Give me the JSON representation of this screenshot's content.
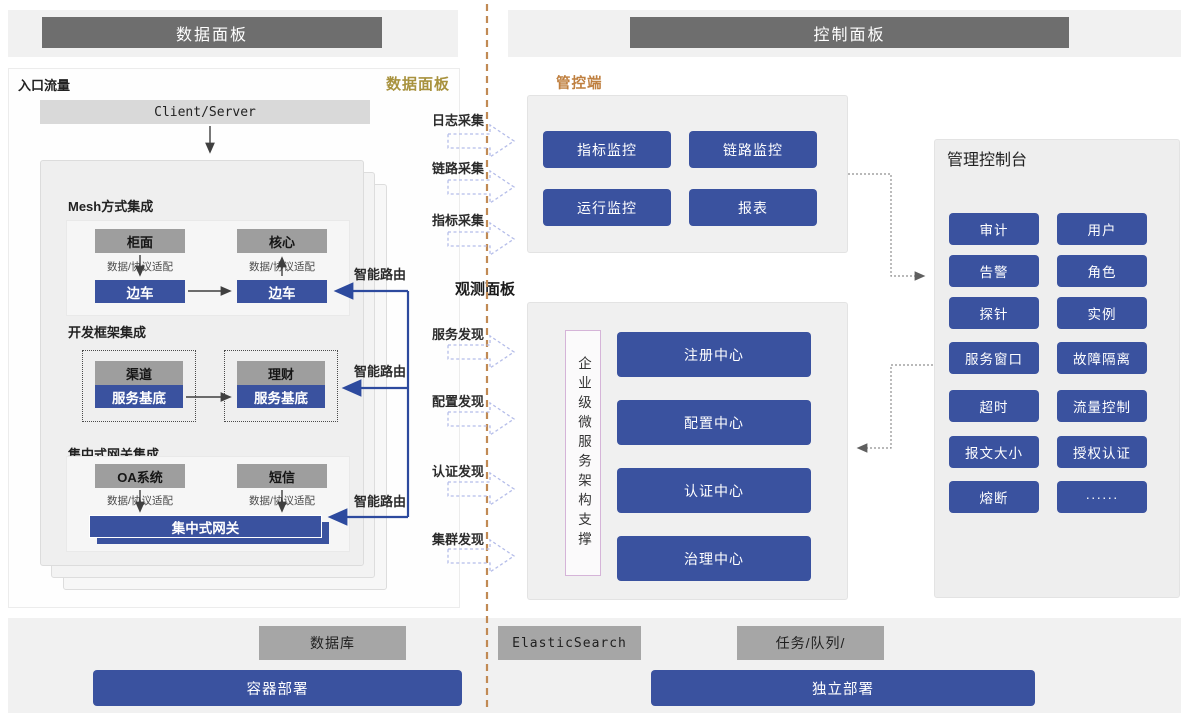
{
  "page": {
    "left_header": "数据面板",
    "right_header": "控制面板"
  },
  "data_plane": {
    "entry_label": "入口流量",
    "panel_tag": "数据面板",
    "client_server": "Client/Server",
    "mesh": {
      "title": "Mesh方式集成",
      "box1": "柜面",
      "adapter1": "数据/协议适配",
      "sidecar1": "边车",
      "box2": "核心",
      "adapter2": "数据/协议适配",
      "sidecar2": "边车"
    },
    "framework": {
      "title": "开发框架集成",
      "box1": "渠道",
      "base1": "服务基底",
      "box2": "理财",
      "base2": "服务基底"
    },
    "gateway": {
      "title": "集中式网关集成",
      "box1": "OA系统",
      "adapter1": "数据/协议适配",
      "box2": "短信",
      "adapter2": "数据/协议适配",
      "bar": "集中式网关"
    },
    "smart_routes": [
      "智能路由",
      "智能路由",
      "智能路由"
    ]
  },
  "flows": {
    "collect": [
      "日志采集",
      "链路采集",
      "指标采集"
    ],
    "observe_title": "观测面板",
    "discover": [
      "服务发现",
      "配置发现",
      "认证发现",
      "集群发现"
    ]
  },
  "control_plane": {
    "tag": "管控端",
    "monitors": [
      "指标监控",
      "链路监控",
      "运行监控",
      "报表"
    ],
    "support_vertical": "企业级微服务架构支撑",
    "centers": [
      "注册中心",
      "配置中心",
      "认证中心",
      "治理中心"
    ],
    "console": {
      "title": "管理控制台",
      "buttons": [
        "审计",
        "用户",
        "告警",
        "角色",
        "探针",
        "实例",
        "服务窗口",
        "故障隔离",
        "超时",
        "流量控制",
        "报文大小",
        "授权认证",
        "熔断",
        "······"
      ]
    }
  },
  "infra": {
    "db": "数据库",
    "es": "ElasticSearch",
    "queue": "任务/队列/",
    "container_deploy": "容器部署",
    "standalone_deploy": "独立部署"
  },
  "colors": {
    "accent_blue": "#3a529f",
    "header_gray": "#6e6e6e",
    "box_gray": "#9e9e9e",
    "gold_tag": "#a8923e",
    "orange_tag": "#bf7f3f",
    "divider_dash": "#c18a54",
    "flow_arrow_dash": "#b5bde9",
    "route_line": "#2d4a9e"
  }
}
